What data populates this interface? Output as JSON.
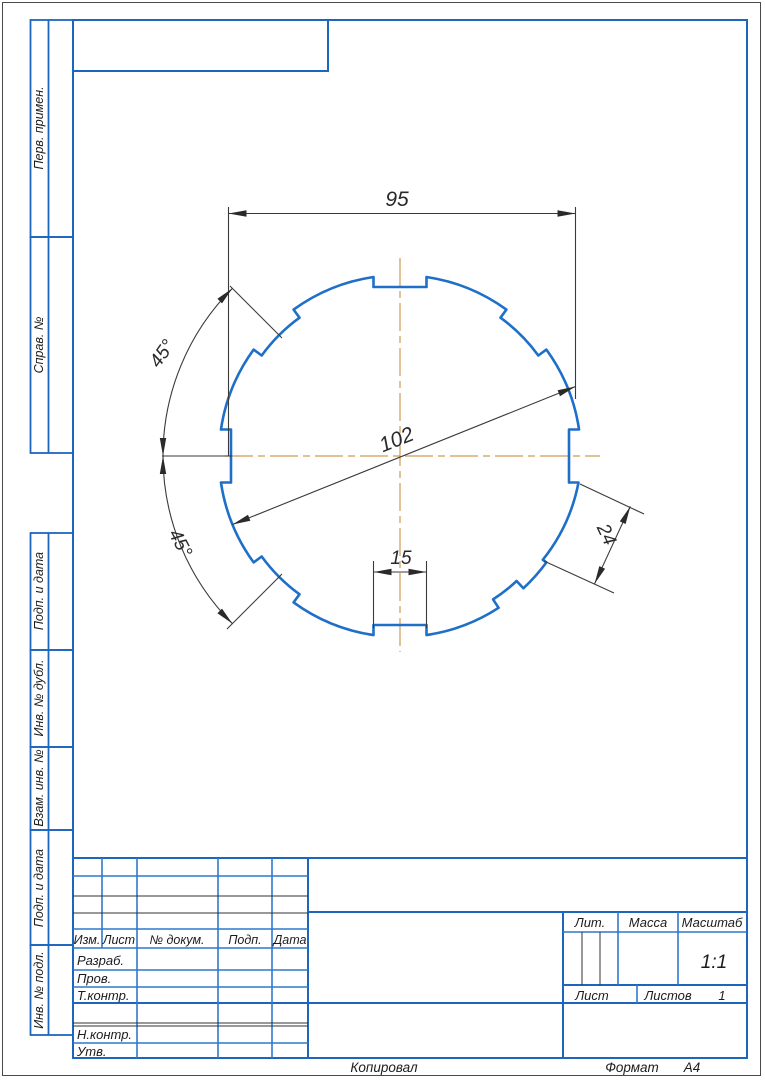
{
  "page": {
    "background": "#ffffff",
    "frame_color": "#1d66bd",
    "part_color": "#1e6fc8",
    "centerline_color": "#cf9a55",
    "dim_color": "#3a3a3a"
  },
  "margin_labels": {
    "items": [
      {
        "label": "Перв. примен."
      },
      {
        "label": "Справ. №"
      },
      {
        "label": "Подп. и дата"
      },
      {
        "label": "Инв. № дубл."
      },
      {
        "label": "Взам. инв. №"
      },
      {
        "label": "Подп. и дата"
      },
      {
        "label": "Инв. № подл."
      }
    ]
  },
  "dimensions": {
    "across_flats": "95",
    "diameter": "102",
    "slot_width": "15",
    "notch_length": "24",
    "angle_upper": "45°",
    "angle_lower": "45°"
  },
  "title_block": {
    "izm": "Изм.",
    "list_col": "Лист",
    "doc_col": "№ докум.",
    "podp_col": "Подп.",
    "data_col": "Дата",
    "razrab": "Разраб.",
    "prov": "Пров.",
    "tkontr": "Т.контр.",
    "nkontr": "Н.контр.",
    "utv": "Утв.",
    "lit": "Лит.",
    "massa": "Масса",
    "masshtab": "Масштаб",
    "scale": "1:1",
    "list": "Лист",
    "listov": "Листов",
    "listov_value": "1"
  },
  "footer": {
    "kopiroval": "Копировал",
    "format_label": "Формат",
    "format_value": "А4"
  }
}
